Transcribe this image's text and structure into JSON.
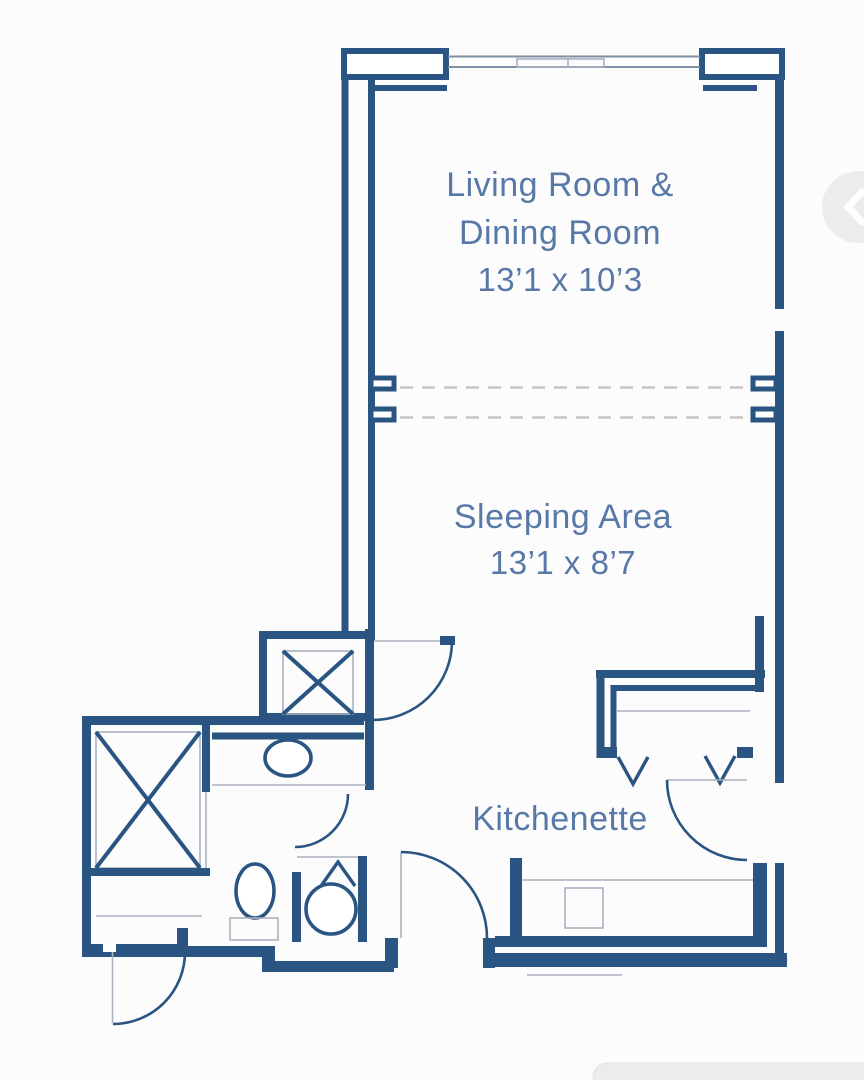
{
  "colors": {
    "wall": "#2a5583",
    "label": "#5878a8",
    "thin": "#a9b2bf",
    "dash": "#c9c5c0",
    "bg": "#fcfcfc",
    "artifact": "#ececeb"
  },
  "labels": {
    "living_line1": "Living Room &",
    "living_line2": "Dining Room",
    "living_dims": "13’1 x 10’3",
    "sleeping_name": "Sleeping Area",
    "sleeping_dims": "13’1 x 8’7",
    "kitchenette_name": "Kitchenette"
  }
}
